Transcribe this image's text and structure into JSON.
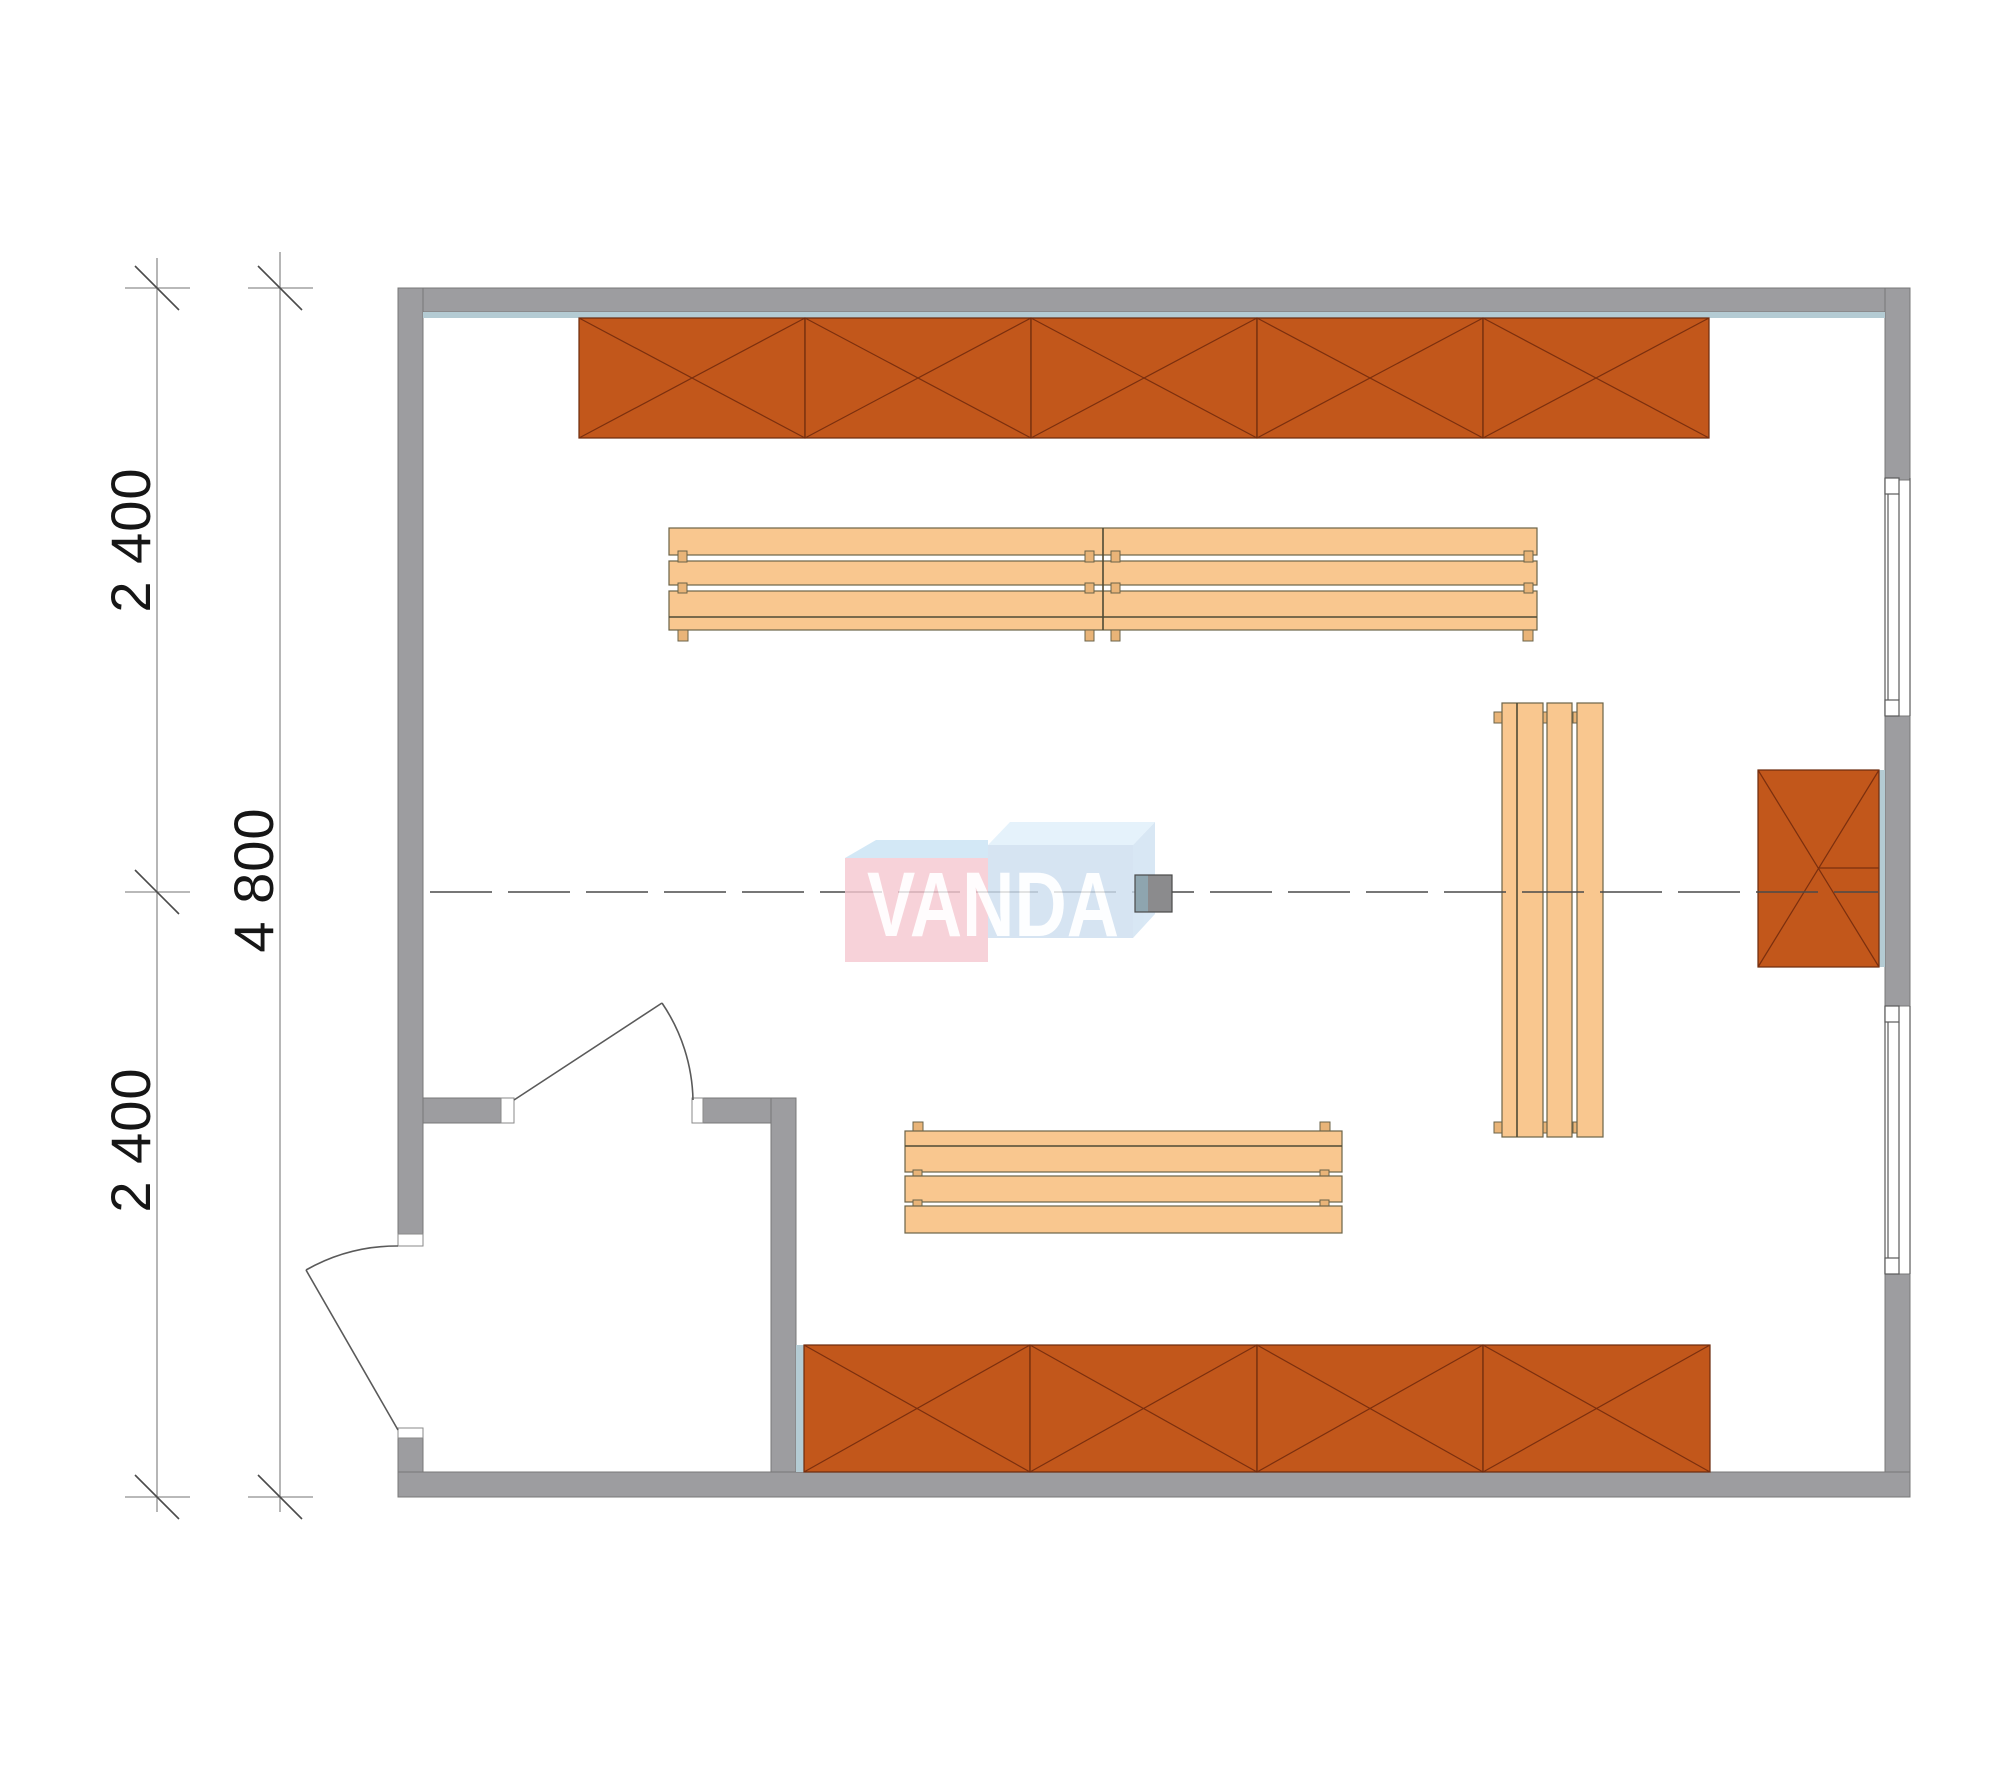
{
  "dimensions": {
    "left_upper": "2 400",
    "left_lower": "2 400",
    "left_total": "4 800"
  },
  "watermark": {
    "text": "VANDA",
    "pink_face": "#f6c8d0",
    "pink_bevel": "#c9e3f5",
    "blue_face": "#cddef0",
    "blue_bevel_top": "#dff0fb",
    "blue_bevel_side": "#cfe2f2"
  },
  "colors": {
    "wall_gray": "#9d9da0",
    "shelf_orange": "#c2571b",
    "shelf_cross_line": "#7b2f0e",
    "bench_wood": "#f9c78f",
    "bench_outline": "#6b6348",
    "wall_panel_blue": "#b4cbd3",
    "dimension_line": "#8f8f8f",
    "dimension_text": "#161616",
    "centerline": "#4a4a4a",
    "marker_square_left": "#8ea5af",
    "marker_square_right": "#8b8b8d"
  },
  "elements": {
    "top_shelf_sections": 5,
    "bottom_shelf_sections": 4,
    "wall_block_sections": 1,
    "windows": 2,
    "doors": 2,
    "benches": 4
  }
}
